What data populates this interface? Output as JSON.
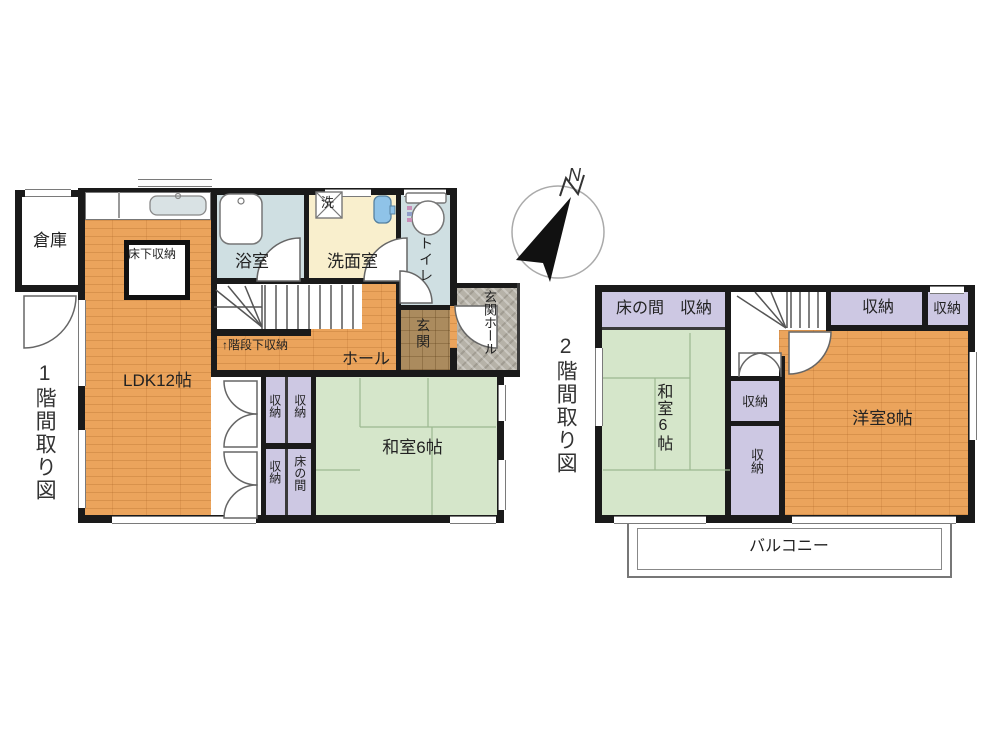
{
  "compass": {
    "north": "N"
  },
  "floor1": {
    "title": "1階間取り図",
    "rooms": {
      "souko": "倉庫",
      "yukashita_shuno": "床下収納",
      "ldk": "LDK12帖",
      "yokushitsu": "浴室",
      "sentakuki": "洗",
      "senmenshitsu": "洗面室",
      "toilet": "トイレ",
      "kaidanshita_shuno": "↑階段下収納",
      "hall": "ホール",
      "genkan": "玄関",
      "genkan_hall": "玄関ホール",
      "shuno_a": "収納",
      "shuno_b": "収納",
      "shuno_c": "収納",
      "tokonoma": "床の間",
      "washitsu": "和室6帖"
    }
  },
  "floor2": {
    "title": "2階間取り図",
    "rooms": {
      "tokonoma": "床の間",
      "shuno_strip": "収納",
      "shuno_top": "収納",
      "shuno_corner": "収納",
      "washitsu": "和室6帖",
      "shuno_mid1": "収納",
      "shuno_mid2": "収納",
      "yoshitsu": "洋室8帖",
      "balcony": "バルコニー"
    }
  },
  "colors": {
    "wall": "#1a1a1a",
    "wood_floor": "#eba45c",
    "tatami": "#d5e6ca",
    "closet": "#cdc8e3",
    "bathroom": "#cfdfe2",
    "washroom": "#f9efcd",
    "entrance_tile": "#ab8b5e",
    "porch_stone": "#b6b2a8"
  }
}
